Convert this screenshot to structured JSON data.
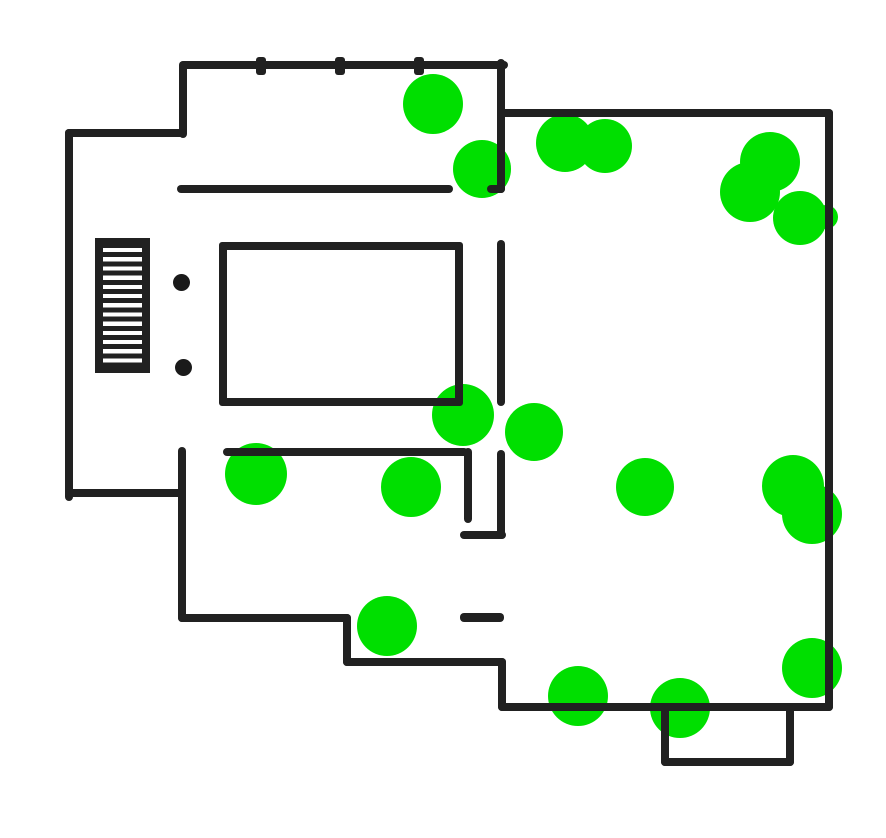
{
  "canvas": {
    "width": 886,
    "height": 838,
    "background": "#ffffff"
  },
  "palette": {
    "wall": "#212121",
    "marker_green": "#00df00",
    "pivot_dark": "#1a1a1a"
  },
  "floorplan": {
    "walls": [
      {
        "name": "top-wall",
        "x": 180,
        "y": 61,
        "w": 328,
        "h": 8
      },
      {
        "name": "entry-stub-left",
        "x": 179,
        "y": 61,
        "w": 8,
        "h": 77
      },
      {
        "name": "upper-left-horizontal",
        "x": 65,
        "y": 129,
        "w": 121,
        "h": 8
      },
      {
        "name": "left-wall",
        "x": 65,
        "y": 129,
        "w": 8,
        "h": 372
      },
      {
        "name": "mid-left-horizontal",
        "x": 65,
        "y": 489,
        "w": 121,
        "h": 8
      },
      {
        "name": "interior-left-vertical",
        "x": 178,
        "y": 447,
        "w": 8,
        "h": 175
      },
      {
        "name": "bottom-wall-1",
        "x": 178,
        "y": 614,
        "w": 173,
        "h": 8
      },
      {
        "name": "bottom-step-1",
        "x": 343,
        "y": 614,
        "w": 8,
        "h": 52
      },
      {
        "name": "bottom-wall-2",
        "x": 343,
        "y": 658,
        "w": 163,
        "h": 8
      },
      {
        "name": "bottom-step-2",
        "x": 498,
        "y": 658,
        "w": 8,
        "h": 53
      },
      {
        "name": "bottom-wall-3",
        "x": 498,
        "y": 703,
        "w": 335,
        "h": 8
      },
      {
        "name": "bay-left",
        "x": 661,
        "y": 705,
        "w": 8,
        "h": 61
      },
      {
        "name": "bay-bottom",
        "x": 661,
        "y": 758,
        "w": 133,
        "h": 8
      },
      {
        "name": "bay-right",
        "x": 786,
        "y": 705,
        "w": 8,
        "h": 61
      },
      {
        "name": "right-wall",
        "x": 825,
        "y": 109,
        "w": 8,
        "h": 602
      },
      {
        "name": "top-right-horizontal",
        "x": 501,
        "y": 109,
        "w": 332,
        "h": 8
      },
      {
        "name": "center-vertical-upper",
        "x": 497,
        "y": 59,
        "w": 8,
        "h": 134
      },
      {
        "name": "center-vertical-foot",
        "x": 487,
        "y": 185,
        "w": 18,
        "h": 8
      },
      {
        "name": "hall-horizontal",
        "x": 177,
        "y": 185,
        "w": 276,
        "h": 8
      },
      {
        "name": "center-vertical-mid",
        "x": 497,
        "y": 240,
        "w": 8,
        "h": 166
      },
      {
        "name": "bedroom-bottom-wall",
        "x": 223,
        "y": 448,
        "w": 245,
        "h": 8
      },
      {
        "name": "closet-inner-wall",
        "x": 464,
        "y": 448,
        "w": 8,
        "h": 75
      },
      {
        "name": "closet-bottom-wall",
        "x": 460,
        "y": 531,
        "w": 46,
        "h": 8
      },
      {
        "name": "closet-right-wall",
        "x": 497,
        "y": 450,
        "w": 8,
        "h": 89
      },
      {
        "name": "half-wall-fragment",
        "x": 460,
        "y": 613,
        "w": 44,
        "h": 9
      }
    ],
    "window_ticks": [
      {
        "x": 256,
        "y": 57,
        "w": 10,
        "h": 18
      },
      {
        "x": 335,
        "y": 57,
        "w": 10,
        "h": 18
      },
      {
        "x": 414,
        "y": 57,
        "w": 10,
        "h": 18
      }
    ],
    "door_pivots": [
      {
        "cx": 181,
        "cy": 282,
        "r": 8.5
      },
      {
        "cx": 183,
        "cy": 367,
        "r": 8.5
      }
    ],
    "staircase": {
      "x": 95,
      "y": 238,
      "w": 55,
      "h": 135,
      "border_top": 5,
      "border_right": 8,
      "border_bottom": 6,
      "border_left": 8,
      "tread_thickness": 5,
      "tread_period": 9.2
    },
    "bed": {
      "x": 219,
      "y": 242,
      "w": 244,
      "h": 164,
      "stroke": 8
    }
  },
  "markers": [
    {
      "cx": 433,
      "cy": 104,
      "r": 30
    },
    {
      "cx": 482,
      "cy": 169,
      "r": 29
    },
    {
      "cx": 565,
      "cy": 143,
      "r": 29
    },
    {
      "cx": 605,
      "cy": 146,
      "r": 27
    },
    {
      "cx": 770,
      "cy": 162,
      "r": 30
    },
    {
      "cx": 750,
      "cy": 192,
      "r": 30
    },
    {
      "cx": 800,
      "cy": 218,
      "r": 27
    },
    {
      "cx": 826,
      "cy": 217,
      "r": 12
    },
    {
      "cx": 256,
      "cy": 474,
      "r": 31
    },
    {
      "cx": 411,
      "cy": 487,
      "r": 30
    },
    {
      "cx": 463,
      "cy": 415,
      "r": 31
    },
    {
      "cx": 534,
      "cy": 432,
      "r": 29
    },
    {
      "cx": 645,
      "cy": 487,
      "r": 29
    },
    {
      "cx": 793,
      "cy": 486,
      "r": 31
    },
    {
      "cx": 812,
      "cy": 514,
      "r": 30
    },
    {
      "cx": 387,
      "cy": 626,
      "r": 30
    },
    {
      "cx": 578,
      "cy": 696,
      "r": 30
    },
    {
      "cx": 680,
      "cy": 708,
      "r": 30
    },
    {
      "cx": 812,
      "cy": 668,
      "r": 30
    }
  ]
}
